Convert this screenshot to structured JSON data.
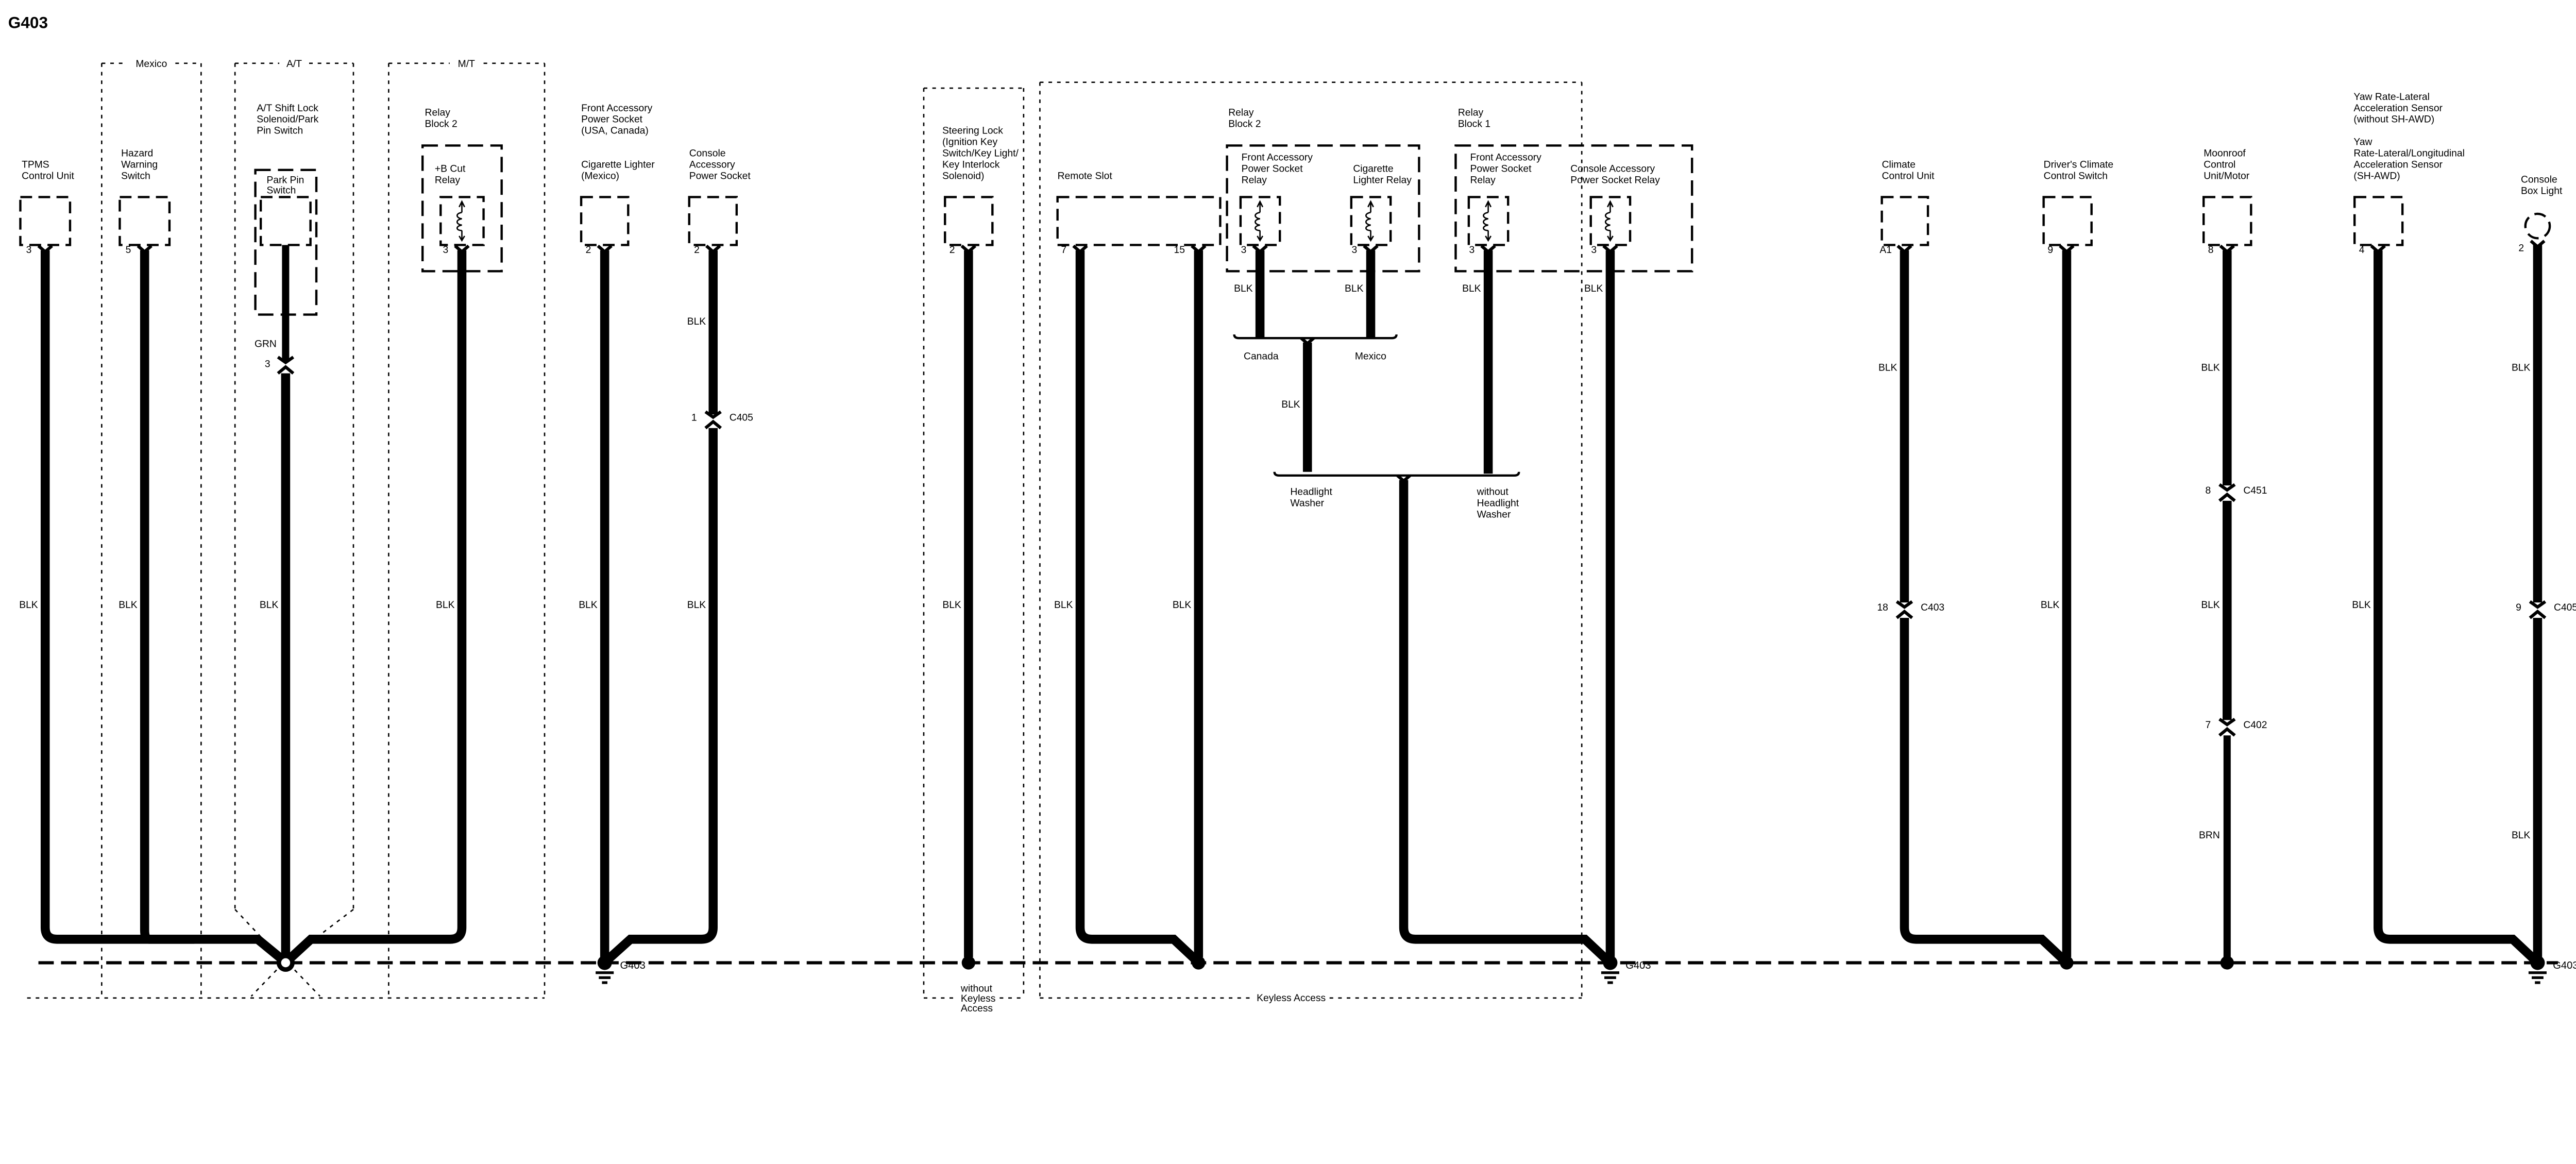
{
  "title": "G403",
  "option_boxes": {
    "mexico": "Mexico",
    "at": "A/T",
    "mt": "M/T",
    "without_keyless": [
      "without",
      "Keyless",
      "Access"
    ],
    "keyless": "Keyless Access"
  },
  "components": {
    "tpms": {
      "label": [
        "TPMS",
        "Control Unit"
      ],
      "pin": "3",
      "wire": "BLK"
    },
    "hazard": {
      "label": [
        "Hazard",
        "Warning",
        "Switch"
      ],
      "pin": "5",
      "wire": "BLK"
    },
    "shift_lock": {
      "label": [
        "A/T Shift Lock",
        "Solenoid/Park",
        "Pin Switch"
      ],
      "inner_label": [
        "Park Pin",
        "Switch"
      ],
      "pigtail_color": "GRN",
      "pin": "3",
      "wire": "BLK"
    },
    "relay_block2_mt": {
      "label": [
        "Relay",
        "Block 2"
      ],
      "relay": {
        "label": [
          "+B Cut",
          "Relay"
        ],
        "pin": "3",
        "wire": "BLK"
      }
    },
    "front_socket": {
      "label": [
        "Front Accessory",
        "Power Socket",
        "(USA, Canada)"
      ],
      "label2": [
        "Cigarette Lighter",
        "(Mexico)"
      ],
      "pin": "2",
      "wire": "BLK"
    },
    "console_socket": {
      "label": [
        "Console",
        "Accessory",
        "Power Socket"
      ],
      "pin": "2",
      "wire1": "BLK",
      "conn_pin": "1",
      "conn": "C405",
      "wire2": "BLK"
    },
    "steering_lock": {
      "label": [
        "Steering Lock",
        "(Ignition Key",
        "Switch/Key Light/",
        "Key Interlock",
        "Solenoid)"
      ],
      "pin": "2",
      "wire": "BLK"
    },
    "remote_slot": {
      "label": "Remote Slot",
      "pin1": "7",
      "pin2": "15",
      "wire1": "BLK",
      "wire2": "BLK"
    },
    "relay_block2": {
      "label": [
        "Relay",
        "Block 2"
      ],
      "relay1": {
        "label": [
          "Front Accessory",
          "Power Socket",
          "Relay"
        ],
        "pin": "3",
        "wire": "BLK"
      },
      "relay2": {
        "label": [
          "Cigarette",
          "Lighter Relay"
        ],
        "pin": "3",
        "wire": "BLK"
      },
      "branch1": "Canada",
      "branch2": "Mexico",
      "merged_wire": "BLK",
      "branch3": [
        "Headlight",
        "Washer"
      ],
      "branch4": [
        "without",
        "Headlight",
        "Washer"
      ]
    },
    "relay_block1": {
      "label": [
        "Relay",
        "Block 1"
      ],
      "relay1": {
        "label": [
          "Front Accessory",
          "Power Socket",
          "Relay"
        ],
        "pin": "3",
        "wire": "BLK"
      },
      "relay2": {
        "label": [
          "Console Accessory",
          "Power Socket Relay"
        ],
        "pin": "3",
        "wire": "BLK"
      }
    },
    "climate": {
      "label": [
        "Climate",
        "Control Unit"
      ],
      "pin": "A1",
      "wire1": "BLK",
      "conn_pin": "18",
      "conn": "C403"
    },
    "drivers_climate": {
      "label": [
        "Driver's Climate",
        "Control Switch"
      ],
      "pin": "9",
      "wire": "BLK"
    },
    "moonroof": {
      "label": [
        "Moonroof",
        "Control",
        "Unit/Motor"
      ],
      "pin": "8",
      "wire1": "BLK",
      "conn1_pin": "8",
      "conn1": "C451",
      "wire2": "BLK",
      "conn2_pin": "7",
      "conn2": "C402",
      "wire3": "BRN"
    },
    "yaw": {
      "label": [
        "Yaw Rate-Lateral",
        "Acceleration Sensor",
        "(without SH-AWD)"
      ],
      "label2": [
        "Yaw",
        "Rate-Lateral/Longitudinal",
        "Acceleration Sensor",
        "(SH-AWD)"
      ],
      "pin": "4",
      "wire": "BLK"
    },
    "console_light": {
      "label": [
        "Console",
        "Box Light"
      ],
      "pin": "2",
      "wire1": "BLK",
      "conn_pin": "9",
      "conn": "C405",
      "wire2": "BLK"
    }
  },
  "grounds": {
    "g1": "G403",
    "g2": "G403",
    "g3": "G403"
  },
  "colors": {
    "wire_black": "#000000",
    "wire_green": "#2bd42b",
    "wire_red": "#e8101a"
  }
}
